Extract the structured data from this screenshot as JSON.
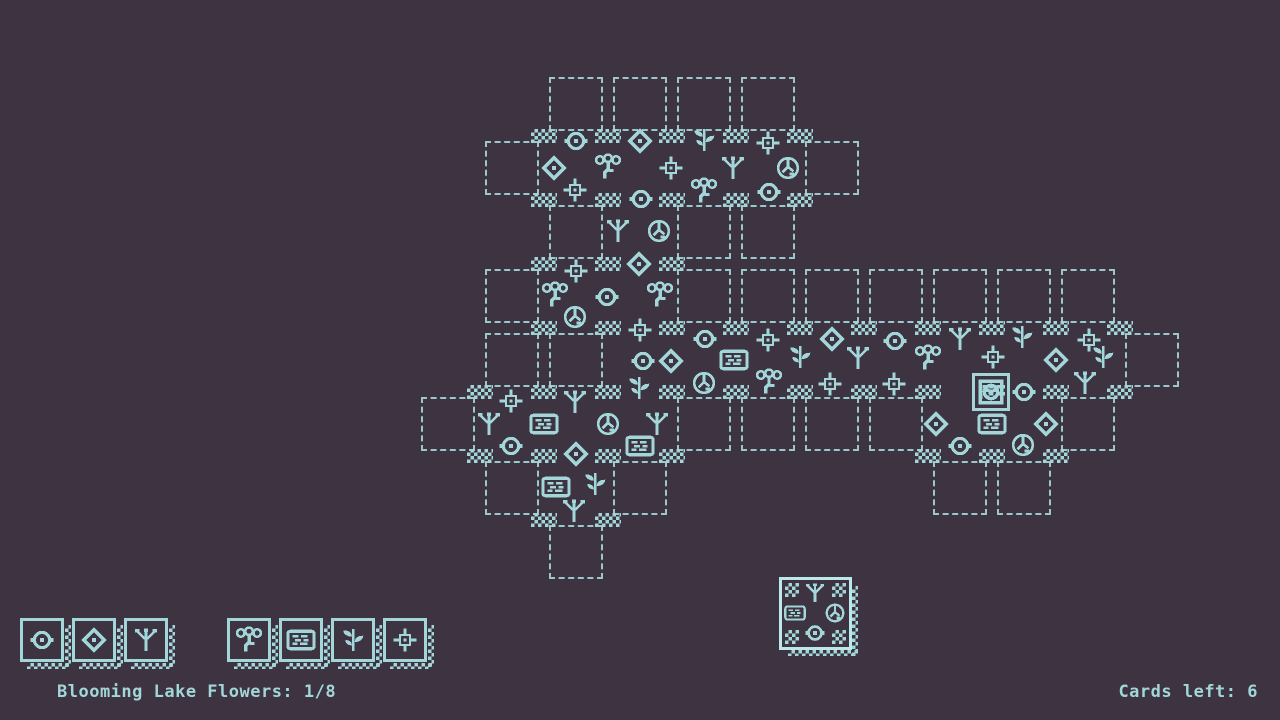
{
  "colors": {
    "background": "#3d3341",
    "foreground": "#a2d6d9",
    "preview_highlight": "#bde8eb"
  },
  "hud": {
    "objective": "Blooming Lake Flowers: 1/8",
    "cards_left": "Cards left: 6"
  },
  "toolbar": {
    "terrain_cards": [
      {
        "icon": "circle-ring"
      },
      {
        "icon": "diamond"
      },
      {
        "icon": "sprout"
      }
    ],
    "flora_cards": [
      {
        "icon": "flower-cluster"
      },
      {
        "icon": "lake"
      },
      {
        "icon": "leaf-plant"
      },
      {
        "icon": "flower-cross"
      }
    ]
  },
  "preview_card": {
    "north": "sprout",
    "west": "lake",
    "east": "rock",
    "south": "circle-ring"
  },
  "board": {
    "origin": {
      "x": 416,
      "y": 72
    },
    "cell": 64,
    "placed": [
      [
        2,
        1
      ],
      [
        3,
        1
      ],
      [
        4,
        1
      ],
      [
        5,
        1
      ],
      [
        3,
        2
      ],
      [
        2,
        3
      ],
      [
        3,
        3
      ],
      [
        3,
        4
      ],
      [
        4,
        4
      ],
      [
        5,
        4
      ],
      [
        6,
        4
      ],
      [
        7,
        4
      ],
      [
        8,
        4
      ],
      [
        9,
        4
      ],
      [
        10,
        4
      ],
      [
        1,
        5
      ],
      [
        2,
        5
      ],
      [
        3,
        5
      ],
      [
        8,
        5
      ],
      [
        9,
        5
      ],
      [
        2,
        6
      ]
    ],
    "slots": [
      [
        2,
        0
      ],
      [
        3,
        0
      ],
      [
        4,
        0
      ],
      [
        5,
        0
      ],
      [
        1,
        1
      ],
      [
        6,
        1
      ],
      [
        2,
        2
      ],
      [
        4,
        2
      ],
      [
        5,
        2
      ],
      [
        1,
        3
      ],
      [
        4,
        3
      ],
      [
        5,
        3
      ],
      [
        6,
        3
      ],
      [
        7,
        3
      ],
      [
        8,
        3
      ],
      [
        9,
        3
      ],
      [
        10,
        3
      ],
      [
        1,
        4
      ],
      [
        2,
        4
      ],
      [
        11,
        4
      ],
      [
        0,
        5
      ],
      [
        4,
        5
      ],
      [
        5,
        5
      ],
      [
        6,
        5
      ],
      [
        7,
        5
      ],
      [
        10,
        5
      ],
      [
        1,
        6
      ],
      [
        3,
        6
      ],
      [
        8,
        6
      ],
      [
        9,
        6
      ],
      [
        2,
        7
      ]
    ],
    "icons": [
      [
        576,
        141,
        "circle-ring"
      ],
      [
        640,
        141,
        "diamond"
      ],
      [
        704,
        140,
        "leaf-plant"
      ],
      [
        768,
        143,
        "flower-cross"
      ],
      [
        554,
        168,
        "diamond"
      ],
      [
        608,
        167,
        "flower-cluster"
      ],
      [
        671,
        168,
        "flower-cross"
      ],
      [
        733,
        168,
        "sprout"
      ],
      [
        788,
        168,
        "rock"
      ],
      [
        575,
        190,
        "flower-cross"
      ],
      [
        641,
        199,
        "circle-ring"
      ],
      [
        704,
        191,
        "flower-cluster"
      ],
      [
        769,
        192,
        "circle-ring"
      ],
      [
        618,
        231,
        "sprout"
      ],
      [
        659,
        231,
        "rock"
      ],
      [
        576,
        271,
        "flower-cross"
      ],
      [
        639,
        264,
        "diamond"
      ],
      [
        555,
        295,
        "flower-cluster"
      ],
      [
        607,
        297,
        "circle-ring"
      ],
      [
        660,
        295,
        "flower-cluster"
      ],
      [
        575,
        317,
        "rock"
      ],
      [
        640,
        330,
        "flower-cross"
      ],
      [
        705,
        339,
        "circle-ring"
      ],
      [
        768,
        340,
        "flower-cross"
      ],
      [
        832,
        339,
        "diamond"
      ],
      [
        895,
        341,
        "circle-ring"
      ],
      [
        960,
        339,
        "sprout"
      ],
      [
        1022,
        337,
        "leaf-plant"
      ],
      [
        1089,
        340,
        "flower-cross"
      ],
      [
        643,
        361,
        "circle-ring"
      ],
      [
        671,
        361,
        "diamond"
      ],
      [
        734,
        360,
        "lake"
      ],
      [
        800,
        357,
        "leaf-plant"
      ],
      [
        858,
        358,
        "sprout"
      ],
      [
        928,
        358,
        "flower-cluster"
      ],
      [
        993,
        357,
        "flower-cross"
      ],
      [
        1056,
        360,
        "diamond"
      ],
      [
        1103,
        357,
        "leaf-plant"
      ],
      [
        511,
        401,
        "flower-cross"
      ],
      [
        575,
        402,
        "sprout"
      ],
      [
        639,
        388,
        "leaf-plant"
      ],
      [
        704,
        383,
        "rock"
      ],
      [
        769,
        382,
        "flower-cluster"
      ],
      [
        830,
        384,
        "flower-cross"
      ],
      [
        894,
        384,
        "flower-cross"
      ],
      [
        991,
        392,
        "rock-framed"
      ],
      [
        1024,
        392,
        "circle-ring"
      ],
      [
        1085,
        383,
        "sprout"
      ],
      [
        489,
        424,
        "sprout"
      ],
      [
        544,
        424,
        "lake"
      ],
      [
        608,
        424,
        "rock"
      ],
      [
        657,
        424,
        "sprout"
      ],
      [
        936,
        424,
        "diamond"
      ],
      [
        992,
        424,
        "lake"
      ],
      [
        1046,
        424,
        "diamond"
      ],
      [
        511,
        446,
        "circle-ring"
      ],
      [
        576,
        454,
        "diamond"
      ],
      [
        640,
        446,
        "lake"
      ],
      [
        960,
        446,
        "circle-ring"
      ],
      [
        1023,
        445,
        "rock"
      ],
      [
        556,
        487,
        "lake"
      ],
      [
        595,
        484,
        "leaf-plant"
      ],
      [
        574,
        511,
        "sprout"
      ]
    ]
  }
}
